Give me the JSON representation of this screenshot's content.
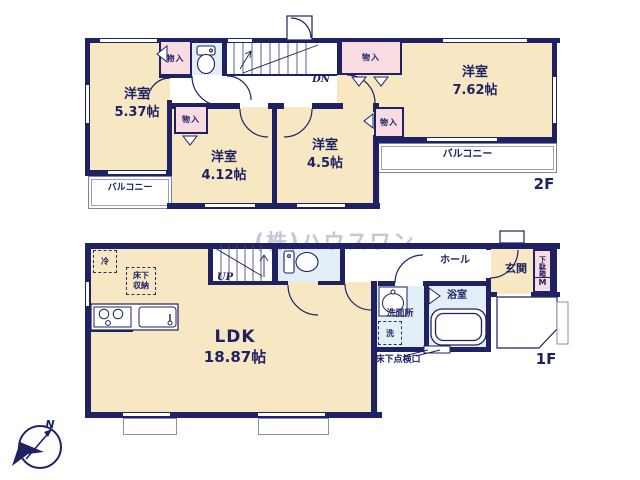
{
  "watermark": "(株)ハウスワン",
  "compass": {
    "north": "N"
  },
  "palette": {
    "wall": "#1e2263",
    "room_fill": "#f7e7c3",
    "closet_fill": "#f9dbe2",
    "wet_area_fill": "#e3eef7",
    "thin_outline": "#8a8fae",
    "watermark": "#c6c7db"
  },
  "floor2": {
    "label": "2F",
    "room_w": {
      "name": "洋室",
      "size": "5.37帖"
    },
    "room_c": {
      "name": "洋室",
      "size": "4.12帖"
    },
    "room_ce": {
      "name": "洋室",
      "size": "4.5帖"
    },
    "room_e": {
      "name": "洋室",
      "size": "7.62帖"
    },
    "closet_nw": "物入",
    "closet_c": "物入",
    "closet_ne": "物入",
    "closet_e": "物入",
    "balcony_w": "バルコニー",
    "balcony_e": "バルコニー",
    "stairs": "DN"
  },
  "floor1": {
    "label": "1F",
    "ldk": {
      "name": "LDK",
      "size": "18.87帖"
    },
    "hall": "ホール",
    "entrance": "玄関",
    "shoe_cabinet": "下駄箱",
    "shoe_cabinet_m": "M",
    "bath": "浴室",
    "washroom": "洗面所",
    "laundry": "洗",
    "fridge": "冷",
    "floor_storage": "床下収納",
    "inspection_hatch": "床下点検口",
    "stairs": "UP"
  }
}
